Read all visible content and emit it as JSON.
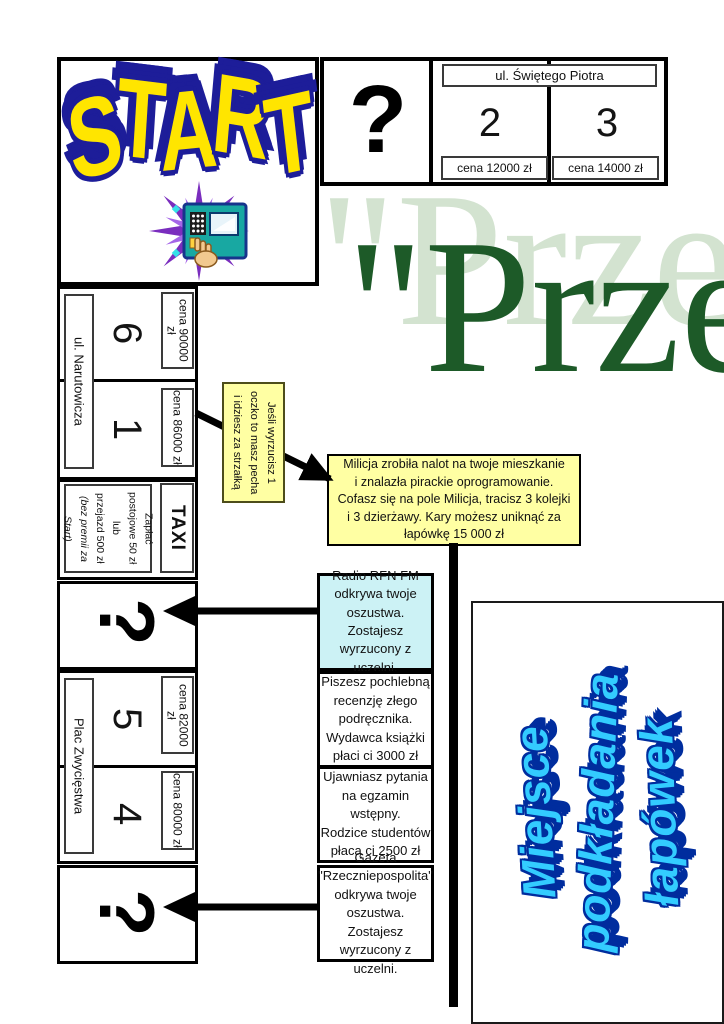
{
  "board": {
    "start_label": "START",
    "start_letters": [
      "S",
      "T",
      "A",
      "R",
      "T"
    ],
    "title_text": "\"Przekręt",
    "mystery_mark": "?",
    "streets": {
      "piotra": "ul. Świętego Piotra",
      "narutowicza": "ul. Narutowicza",
      "zwyciestwa": "Plac Zwycięstwa"
    },
    "cells": {
      "c2": {
        "number": "2",
        "price": "cena 12000 zł"
      },
      "c3": {
        "number": "3",
        "price": "cena 14000 zł"
      },
      "c6": {
        "number": "6",
        "price": "cena 90000 zł"
      },
      "c1": {
        "number": "1",
        "price": "cena 86000 zł"
      },
      "c5": {
        "number": "5",
        "price": "cena 82000 zł"
      },
      "c4": {
        "number": "4",
        "price": "cena 80000 zł"
      }
    },
    "taxi": {
      "label": "TAXI",
      "note_lines": [
        "Zapłać",
        "postojowe 50 zł",
        "lub",
        "przejazd 500 zł"
      ],
      "note_italic_lines": [
        "(bez premii za",
        "Start)"
      ]
    }
  },
  "notes": {
    "jesli": {
      "lines": [
        "Jeśli wyrzucisz 1",
        "oczko to masz pecha",
        "i idziesz za strzałką"
      ]
    },
    "milicja": {
      "lines": [
        "Milicja zrobiła nalot na twoje mieszkanie",
        "i znalazła pirackie oprogramowanie.",
        "Cofasz się na pole Milicja, tracisz 3 kolejki",
        "i 3 dzierżawy. Kary możesz uniknąć za",
        "łapówkę 15 000 zł"
      ]
    },
    "radio": {
      "lines": [
        "Radio RFN FM",
        "odkrywa twoje",
        "oszustwa. Zostajesz",
        "wyrzucony z uczelni."
      ]
    },
    "piszesz": {
      "lines": [
        "Piszesz pochlebną",
        "recenzję złego",
        "podręcznika.",
        "Wydawca książki",
        "płaci ci 3000 zł"
      ]
    },
    "ujawniasz": {
      "lines": [
        "Ujawniasz pytania",
        "na egzamin",
        "wstępny.",
        "Rodzice studentów",
        "płacą ci 2500 zł"
      ]
    },
    "gazeta": {
      "lines": [
        "Gazeta",
        "\"Rzeczniepospolita\"",
        "odkrywa twoje",
        "oszustwa. Zostajesz",
        "wyrzucony z uczelni."
      ]
    }
  },
  "wordart": {
    "bribe_lines": [
      "Miejsce",
      "podkładania",
      "łapówek"
    ]
  },
  "colors": {
    "note_yellow": "#ffffa3",
    "note_cyan": "#ccf2f5",
    "wordart_cyan": "#33ccff",
    "wordart_navy": "#002d9e",
    "start_yellow": "#ffe500",
    "start_navy": "#1d1d99",
    "title_dark_green": "#1d5a28",
    "title_light_green": "#d3e3d0"
  }
}
